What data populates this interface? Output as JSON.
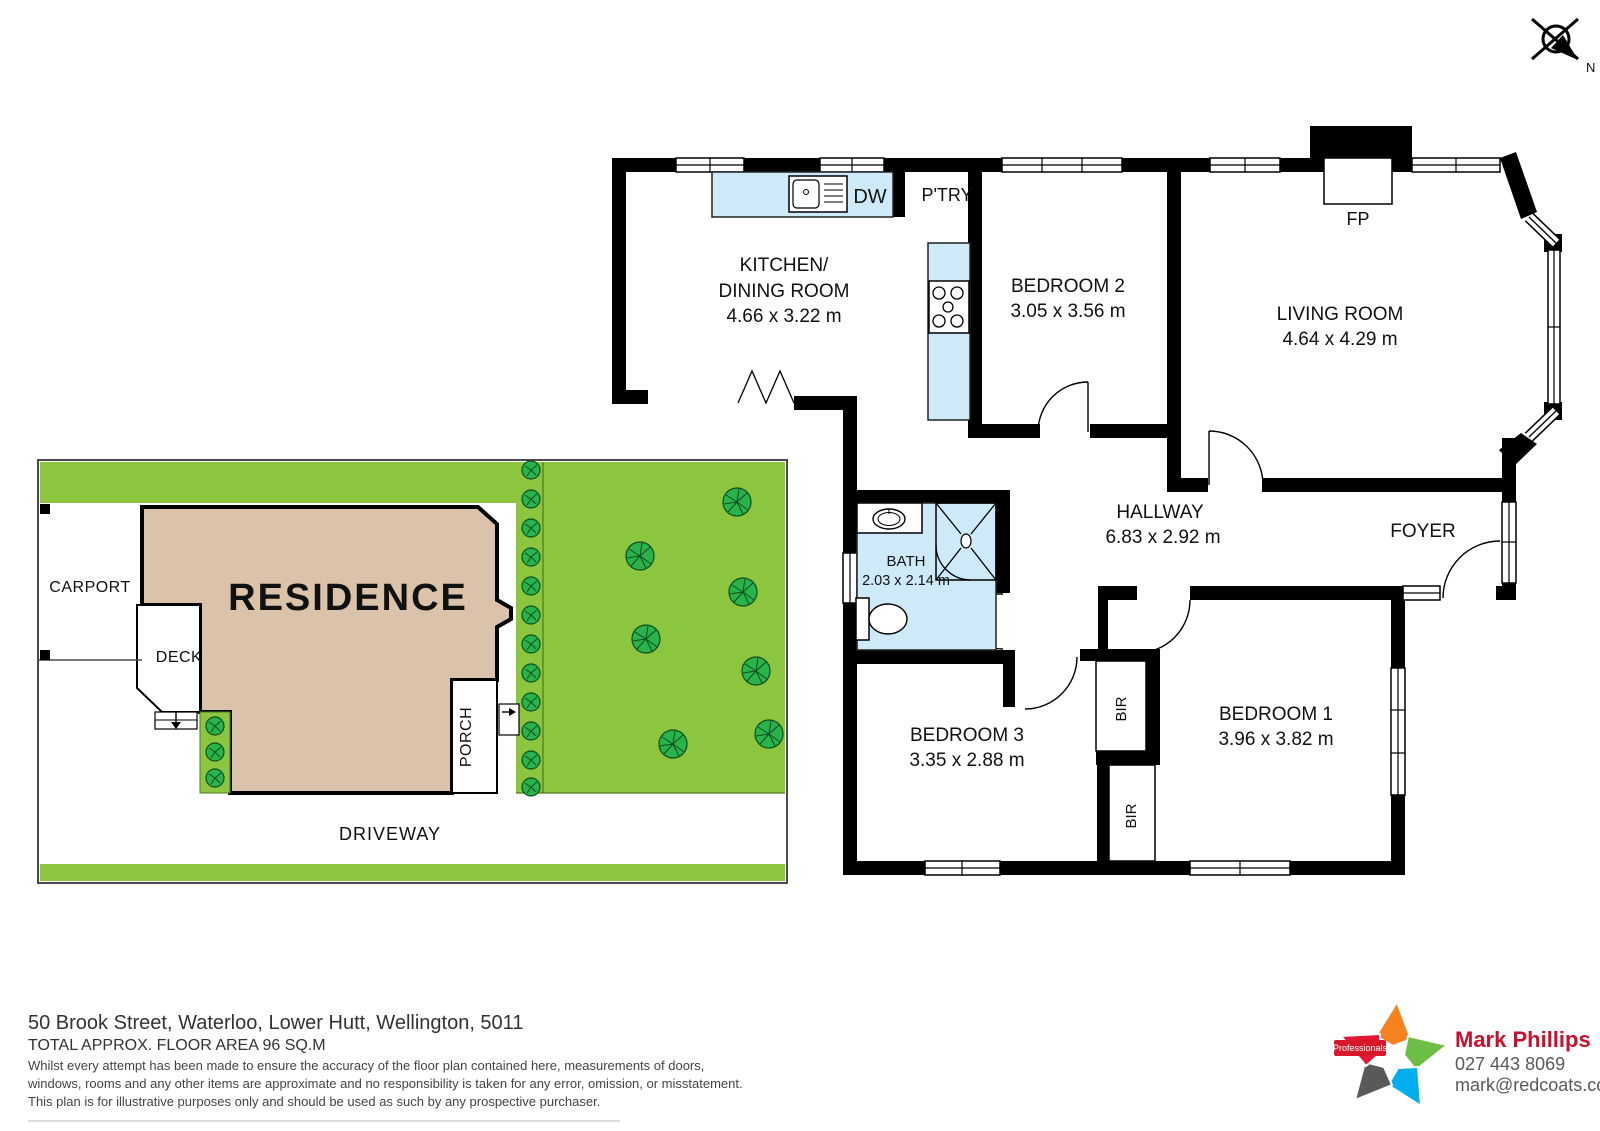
{
  "compass": {
    "north": "N"
  },
  "colors": {
    "wall": "#000000",
    "fixture_blue": "#CEE9F8",
    "lawn_green": "#8CC63E",
    "tree_green": "#29B34A",
    "residence_tan": "#DBC2AA",
    "brand_red": "#C8102E",
    "star_red": "#E31837",
    "star_orange": "#F5821F",
    "star_green": "#6CBE45",
    "star_blue": "#00AEEF",
    "star_gray": "#58595B"
  },
  "floorplan": {
    "kitchen": {
      "name1": "KITCHEN/",
      "name2": "DINING ROOM",
      "dims": "4.66 x 3.22 m"
    },
    "bedroom2": {
      "name": "BEDROOM 2",
      "dims": "3.05 x 3.56 m"
    },
    "living": {
      "name": "LIVING ROOM",
      "dims": "4.64 x 4.29 m"
    },
    "hallway": {
      "name": "HALLWAY",
      "dims": "6.83 x 2.92 m"
    },
    "bath": {
      "name": "BATH",
      "dims": "2.03 x 2.14 m"
    },
    "bedroom3": {
      "name": "BEDROOM 3",
      "dims": "3.35 x 2.88 m"
    },
    "bedroom1": {
      "name": "BEDROOM 1",
      "dims": "3.96 x 3.82 m"
    },
    "foyer": "FOYER",
    "fireplace": "FP",
    "dishwasher": "DW",
    "pantry": "P'TRY",
    "bir": "BIR"
  },
  "siteplan": {
    "carport": "CARPORT",
    "deck": "DECK",
    "residence": "RESIDENCE",
    "porch": "PORCH",
    "driveway": "DRIVEWAY"
  },
  "footer": {
    "address": "50 Brook Street, Waterloo, Lower Hutt, Wellington, 5011",
    "floor_area": "TOTAL APPROX. FLOOR AREA 96 SQ.M",
    "disclaimer1": "Whilst every attempt has been made to ensure the accuracy of the floor plan contained here, measurements of doors,",
    "disclaimer2": "windows, rooms and any other items are approximate and no responsibility is taken for any error, omission, or misstatement.",
    "disclaimer3": "This plan is for illustrative purposes only and should be used as such by any prospective purchaser."
  },
  "agent": {
    "brand": "Professionals",
    "name": "Mark Phillips",
    "phone": "027 443 8069",
    "email": "mark@redcoats.co.nz"
  }
}
